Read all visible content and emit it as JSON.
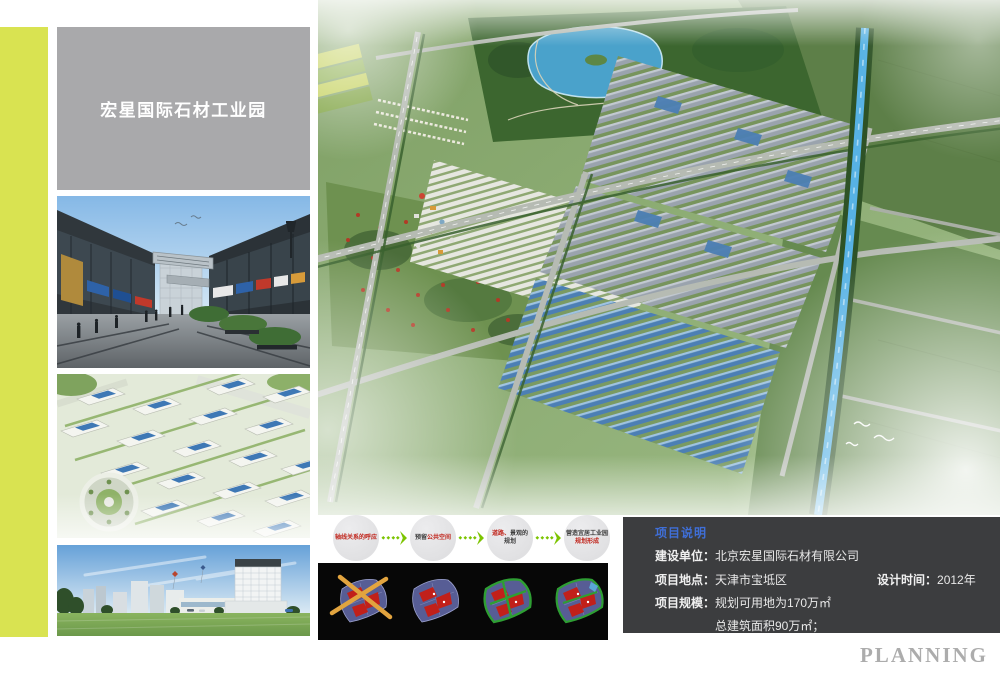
{
  "header": {
    "title": "宏星国际石材工业园"
  },
  "flow": {
    "steps": [
      {
        "segments": [
          {
            "text": "轴线关系的呼应",
            "style": "color:#c0251c"
          }
        ]
      },
      {
        "segments": [
          {
            "text": "预留",
            "style": "color:#3c3c3c"
          },
          {
            "text": "公共空间",
            "style": "color:#c0251c"
          }
        ]
      },
      {
        "segments": [
          {
            "text": "道路、",
            "style": "color:#c0251c"
          },
          {
            "text": "景观的规划",
            "style": "color:#3c3c3c"
          }
        ]
      },
      {
        "segments": [
          {
            "text": "营造宜居工业园",
            "style": "color:#3c3c3c"
          },
          {
            "text": "规划形成",
            "style": "color:#c0251c"
          }
        ]
      }
    ],
    "arrow_color": "#7cc400"
  },
  "info_box": {
    "header": "项目说明",
    "line1": {
      "label": "建设单位：",
      "value": "北京宏星国际石材有限公司"
    },
    "line2": {
      "label": "项目地点：",
      "value": "天津市宝坻区",
      "right_label": "设计时间：",
      "right_value": "2012年"
    },
    "line3": {
      "label": "项目规模：",
      "value": "规划可用地为170万㎡"
    },
    "line4": {
      "value": "总建筑面积90万㎡；"
    },
    "header_color": "#3f6fd8",
    "background": "#3c3d3f"
  },
  "footer": {
    "planning_label": "PLANNING"
  },
  "colors": {
    "accent_stripe": "#d9e351",
    "title_card_bg": "#a9a9ab",
    "flow_red": "#c0251c",
    "flow_dark": "#3c3c3c",
    "flow_arrow_green": "#7cc400",
    "canal_blue": "#57b2e4",
    "roof_blue": "#4c7fb4"
  }
}
